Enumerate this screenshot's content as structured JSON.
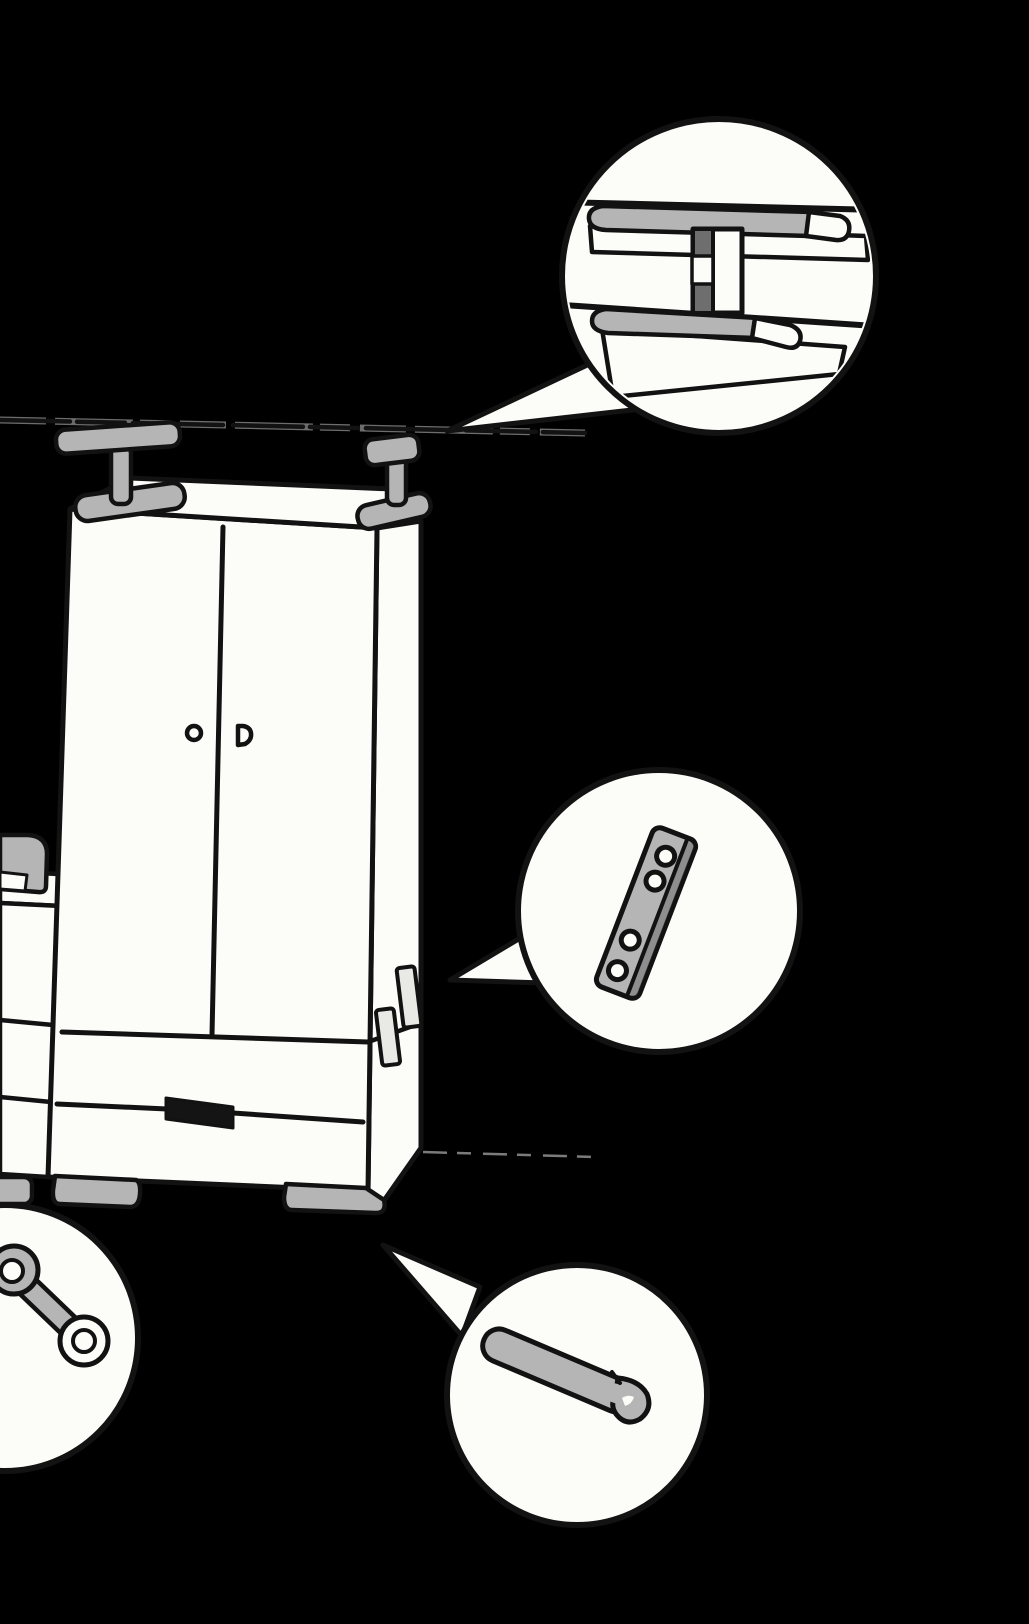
{
  "canvas": {
    "width": 1029,
    "height": 1624,
    "background": "#000000"
  },
  "palette": {
    "background": "#000000",
    "outline": "#121212",
    "paper": "#fcfcf9",
    "grey": "#b5b5b5",
    "grey_dark": "#6e6e6e",
    "near_black": "#141414",
    "plate_light": "#e9e9e6",
    "halo": "#d9d9d9",
    "floor_line": "#9a9a9a"
  },
  "scene": {
    "type": "furniture-assembly-illustration",
    "description": "Hand-drawn wardrobe with two doors and a bottom drawer standing on feet, anchored to a dashed wall rail; a second unit is partially visible at the left edge; a faint dashed floor line extends right; four circular detail callouts highlight hardware.",
    "wardrobe": {
      "doors": 2,
      "knobs": 2,
      "drawer_handle": "solid black bar on drawer front",
      "top_anchor_brackets": 2,
      "feet_visible": 2,
      "side_mounting_plates": 2
    },
    "neighbor_unit": "partial cabinet cropped at left edge with its own top bracket, two divider lines and a foot",
    "wall_rail": "long dashed horizontal line across the top, sloping slightly down to the right",
    "floor_line": "faint short dashed line at lower right",
    "callouts": [
      {
        "id": "rail-joint",
        "position": "top-right",
        "shows": "two rail boards with grey top surfaces joined by a vertical connector pin with a white collar"
      },
      {
        "id": "mounting-plate",
        "position": "middle-right",
        "shows": "angled flat connecting plate with four screw holes"
      },
      {
        "id": "ring-spanner",
        "position": "bottom-left (cropped)",
        "shows": "double-ring spanner tool"
      },
      {
        "id": "edge-strip",
        "position": "bottom-center",
        "shows": "grey trim strip with rolled-under end"
      }
    ]
  }
}
